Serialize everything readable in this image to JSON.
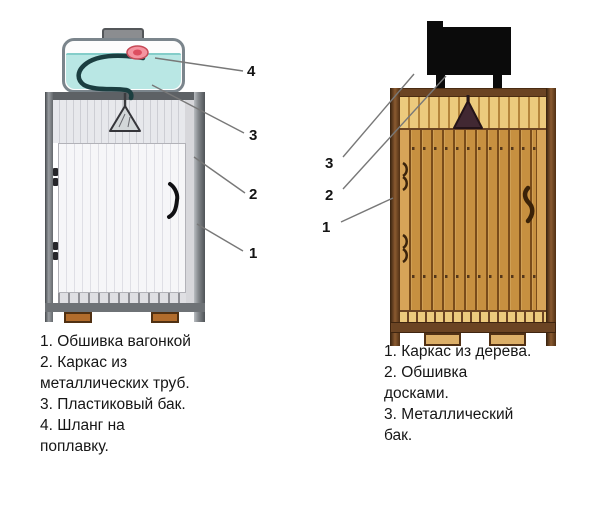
{
  "palette": {
    "water": "#b9e7e4",
    "float_pink": "#f494a0",
    "metal_gray": "#84888c",
    "panel_light": "#e7e8ec",
    "wood_dark": "#6b4423",
    "wood_mid": "#c79040",
    "wood_light": "#ecca7d",
    "tank_black": "#0b0b0b",
    "leader_line": "#787878",
    "text": "#161616"
  },
  "left_shower": {
    "callouts": [
      "4",
      "3",
      "2",
      "1"
    ],
    "legend": [
      "1. Обшивка вагонкой",
      "2. Каркас из",
      "металлических труб.",
      "3. Пластиковый бак.",
      "4. Шланг на",
      "поплавку."
    ]
  },
  "right_shower": {
    "callouts": [
      "3",
      "2",
      "1"
    ],
    "legend": [
      "1. Каркас из дерева.",
      "2. Обшивка",
      "досками.",
      "3. Металлический",
      "бак."
    ]
  }
}
